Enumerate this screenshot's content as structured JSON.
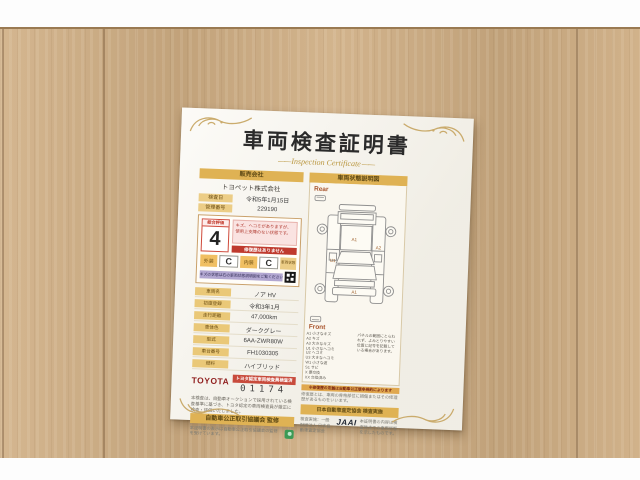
{
  "certificate": {
    "title": "車両検査証明書",
    "subtitle": "Inspection Certificate",
    "left": {
      "header": "販売会社",
      "company": "トヨペット株式会社",
      "info_rows": [
        {
          "label": "検査日",
          "value": "令和5年1月15日"
        },
        {
          "label": "管理番号",
          "value": "229190"
        }
      ],
      "evaluation": {
        "label": "総合評価",
        "score": "4",
        "comment": "キズ、ヘコミがありますが、使用上支障のない状態です。",
        "banner": "修復歴はありません",
        "exterior_label": "外装",
        "exterior_value": "C",
        "interior_label": "内装",
        "interior_value": "C",
        "qr_label": "車両状態",
        "purple_note": "キズの状態は右の車両状態説明図をご覧ください"
      },
      "detail_rows": [
        {
          "label": "車両名",
          "value": "ノア HV"
        },
        {
          "label": "初度登録",
          "value": "令和3年1月"
        },
        {
          "label": "走行距離",
          "value": "47,000km"
        },
        {
          "label": "車体色",
          "value": "ダークグレー"
        },
        {
          "label": "型式",
          "value": "6AA-ZWR80W"
        },
        {
          "label": "車台番号",
          "value": "FH1030305"
        },
        {
          "label": "燃料",
          "value": "ハイブリッド"
        }
      ],
      "toyota_logo": "TOYOTA",
      "toyota_band": "トヨタ認定車両検査員検査済",
      "certificate_number": "01174",
      "disclaimer": "本検査は、自動車オークションで採用されている検査基準に基づき、トヨタ認定の車両検査員が厳正に検査・評価いたしました。",
      "supervision_band": "自動車公正取引協議会 監修",
      "supervision_note": "本証明書の表示は自動車公正取引協議会の監修を受けています。"
    },
    "right": {
      "header": "車両状態説明図",
      "rear_label": "Rear",
      "front_label": "Front",
      "diagram_codes": [
        "A1",
        "U1",
        "A2",
        "A1"
      ],
      "legend": [
        "A1 小さなキズ",
        "A2 キズ",
        "A3 大きなキズ",
        "U1 小さなヘコミ",
        "U2 ヘコミ",
        "U3 大きなヘコミ",
        "W1 小さな波",
        "S1 サビ",
        "X 要交換",
        "XX 交換済み"
      ],
      "legend_note": "パネルの範囲にとらわれず、よみとりやすい位置に記号を記載している場合があります。",
      "repair_band": "※修復歴の定義は自動車公正競争規約によります",
      "repair_note": "修復歴とは、車両の骨格部位に損傷またはその修理歴があるものをいいます。",
      "jaai_band": "日本自動車査定協会 検査実施",
      "jaai_logo": "JAAI",
      "jaai_note_left": "検査実施：一般財団法人 日本自動車査定協会",
      "jaai_note_right": "本証明書の内容は検査時点での車両状態を示したものです。"
    },
    "colors": {
      "band_gold": "#dfb254",
      "accent_red": "#c0392b",
      "toyota_red": "#8f1d1d",
      "purple": "#b2a7d1",
      "paper": "#f8f5ec",
      "wood": "#ccab81"
    }
  }
}
